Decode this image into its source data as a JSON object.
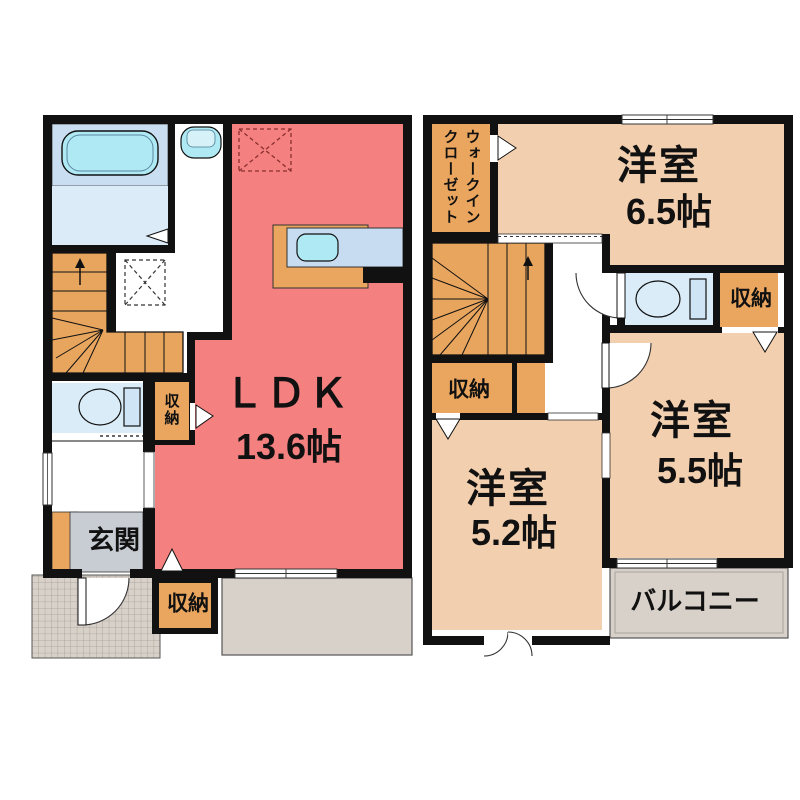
{
  "plan": {
    "floor1": {
      "ldk": {
        "name": "ＬＤＫ",
        "size": "13.6帖"
      },
      "entrance_label": "玄関",
      "storage_hall": "収納",
      "storage_south": "収納"
    },
    "floor2": {
      "walk_in_closet": {
        "line1": "ウォークイン",
        "line2": "クローゼット"
      },
      "room_a": {
        "name": "洋室",
        "size": "6.5帖"
      },
      "room_b": {
        "name": "洋室",
        "size": "5.5帖"
      },
      "room_c": {
        "name": "洋室",
        "size": "5.2帖"
      },
      "storage_stairs": "収納",
      "storage_hall": "収納",
      "balcony_label": "バルコニー"
    },
    "colors": {
      "wall": "#111111",
      "ldk_red": "#f48080",
      "western_room_tan": "#f2cfae",
      "storage_orange": "#eaa55e",
      "stairs_orange": "#e8a55e",
      "entrance_mat_grey": "#c8ccd3",
      "outdoor_grey": "#d8d1c9",
      "bath_cyan": "#aee9f4",
      "bath_panel_blue": "#c9dff1",
      "toilet_room_blue": "#d9ecf8",
      "kitchen_counter_blue": "#c7dcf0"
    }
  }
}
